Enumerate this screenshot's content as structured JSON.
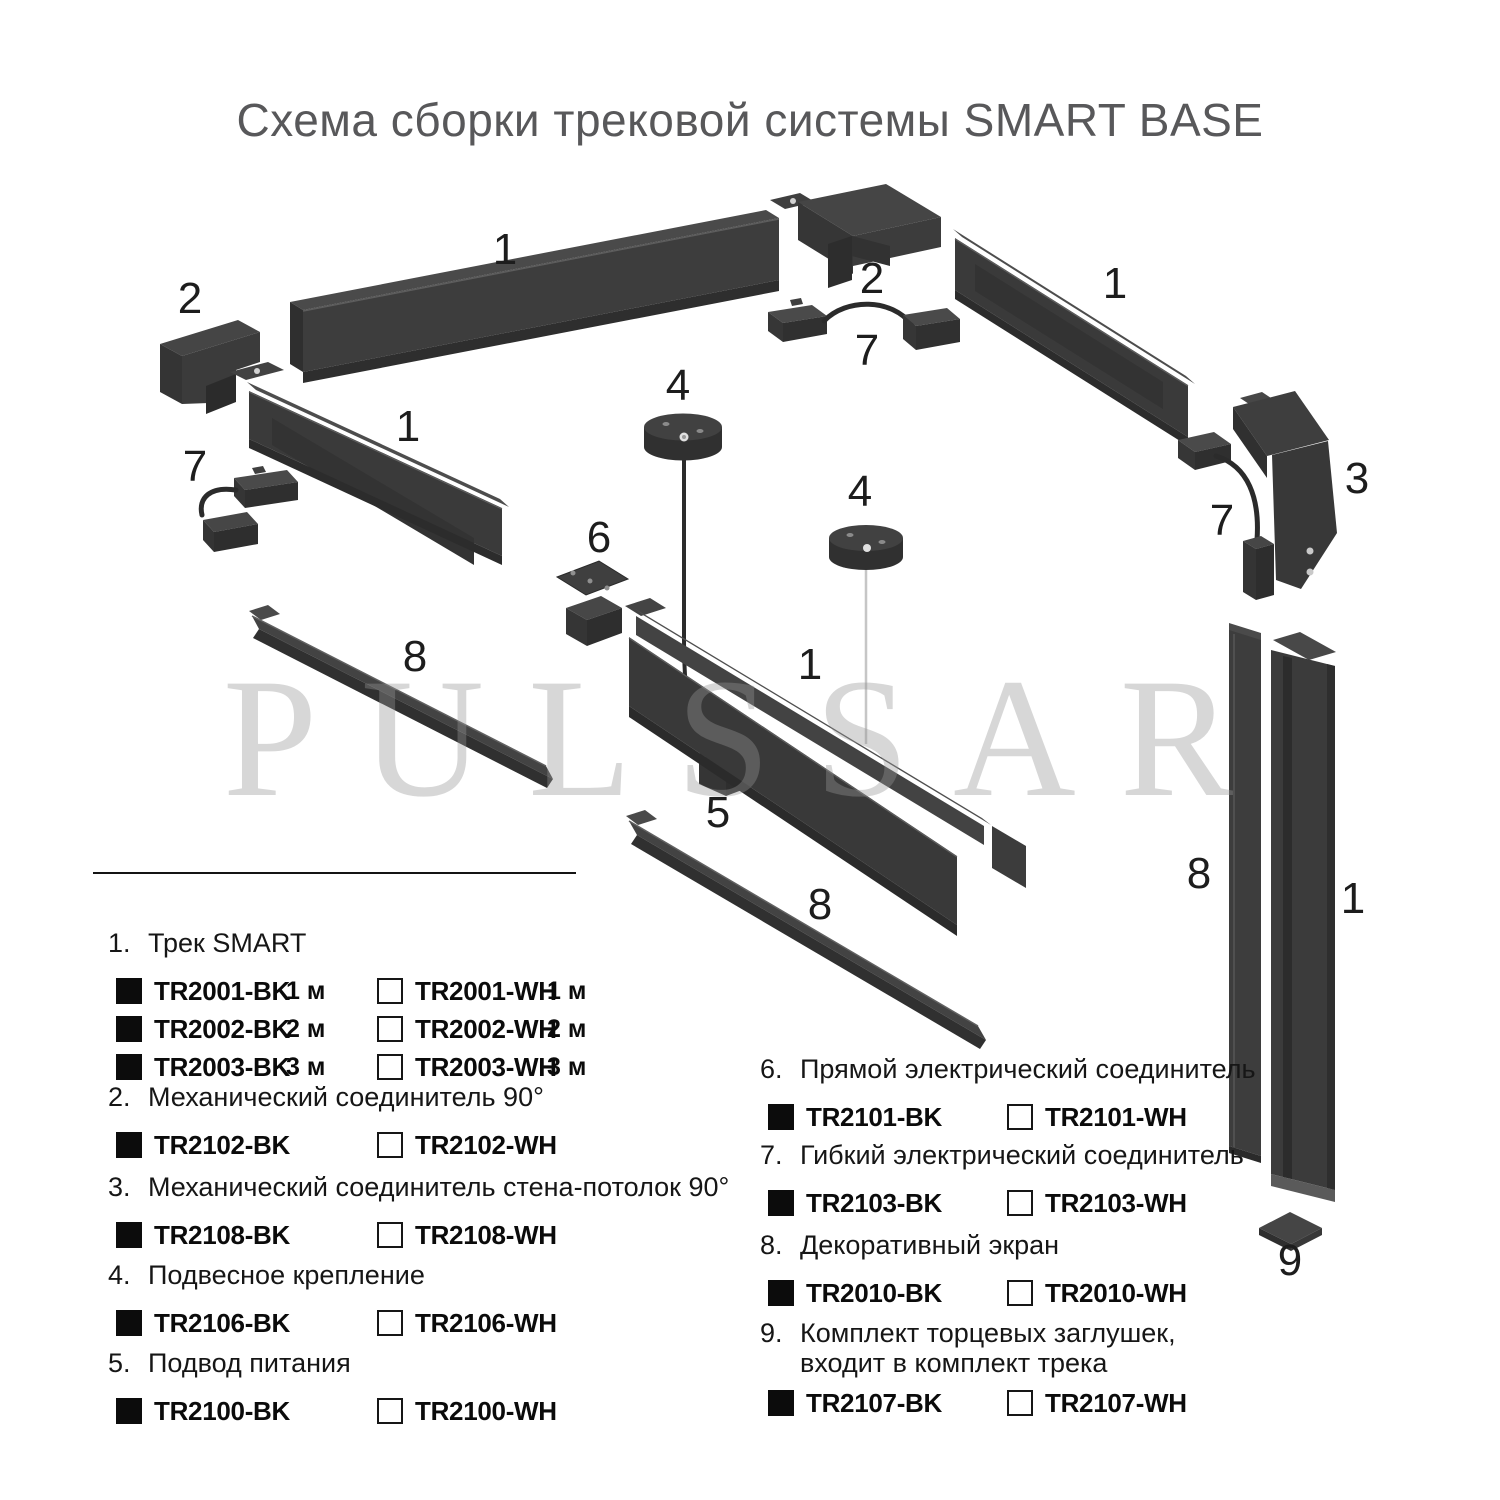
{
  "title": "Схема сборки трековой системы SMART BASE",
  "watermark": "PULSSAR",
  "colors": {
    "background": "#ffffff",
    "part_fill_main": "#3d3d3d",
    "part_fill_shadow": "#2e2e2e",
    "part_fill_top": "#474747",
    "text": "#161616",
    "title_text": "#58585a",
    "watermark_gray": "#d8d8d8",
    "swatch_black": "#0c0c0c",
    "swatch_white": "#ffffff"
  },
  "diagram": {
    "labels": [
      {
        "text": "1"
      },
      {
        "text": "2"
      },
      {
        "text": "1"
      },
      {
        "text": "7"
      },
      {
        "text": "2"
      },
      {
        "text": "7"
      },
      {
        "text": "1"
      },
      {
        "text": "3"
      },
      {
        "text": "7"
      },
      {
        "text": "4"
      },
      {
        "text": "4"
      },
      {
        "text": "6"
      },
      {
        "text": "1"
      },
      {
        "text": "5"
      },
      {
        "text": "8"
      },
      {
        "text": "8"
      },
      {
        "text": "8"
      },
      {
        "text": "1"
      },
      {
        "text": "9"
      }
    ]
  },
  "legend": {
    "sections": [
      {
        "num": "1.",
        "title": "Трек SMART",
        "rows": [
          {
            "bk_code": "TR2001-BK",
            "bk_size": "1 м",
            "wh_code": "TR2001-WH",
            "wh_size": "1 м"
          },
          {
            "bk_code": "TR2002-BK",
            "bk_size": "2 м",
            "wh_code": "TR2002-WH",
            "wh_size": "2 м"
          },
          {
            "bk_code": "TR2003-BK",
            "bk_size": "3 м",
            "wh_code": "TR2003-WH",
            "wh_size": "3 м"
          }
        ]
      },
      {
        "num": "2.",
        "title": "Механический соединитель 90°",
        "rows": [
          {
            "bk_code": "TR2102-BK",
            "wh_code": "TR2102-WH"
          }
        ]
      },
      {
        "num": "3.",
        "title": "Механический соединитель стена-потолок 90°",
        "rows": [
          {
            "bk_code": "TR2108-BK",
            "wh_code": "TR2108-WH"
          }
        ]
      },
      {
        "num": "4.",
        "title": "Подвесное крепление",
        "rows": [
          {
            "bk_code": "TR2106-BK",
            "wh_code": "TR2106-WH"
          }
        ]
      },
      {
        "num": "5.",
        "title": "Подвод питания",
        "rows": [
          {
            "bk_code": "TR2100-BK",
            "wh_code": "TR2100-WH"
          }
        ]
      },
      {
        "num": "6.",
        "title": "Прямой электрический соединитель",
        "rows": [
          {
            "bk_code": "TR2101-BK",
            "wh_code": "TR2101-WH"
          }
        ]
      },
      {
        "num": "7.",
        "title": "Гибкий электрический соединитель",
        "rows": [
          {
            "bk_code": "TR2103-BK",
            "wh_code": "TR2103-WH"
          }
        ]
      },
      {
        "num": "8.",
        "title": "Декоративный экран",
        "rows": [
          {
            "bk_code": "TR2010-BK",
            "wh_code": "TR2010-WH"
          }
        ]
      },
      {
        "num": "9.",
        "title": "Комплект торцевых заглушек,",
        "title2": "входит в комплект трека",
        "rows": [
          {
            "bk_code": "TR2107-BK",
            "wh_code": "TR2107-WH"
          }
        ]
      }
    ]
  }
}
